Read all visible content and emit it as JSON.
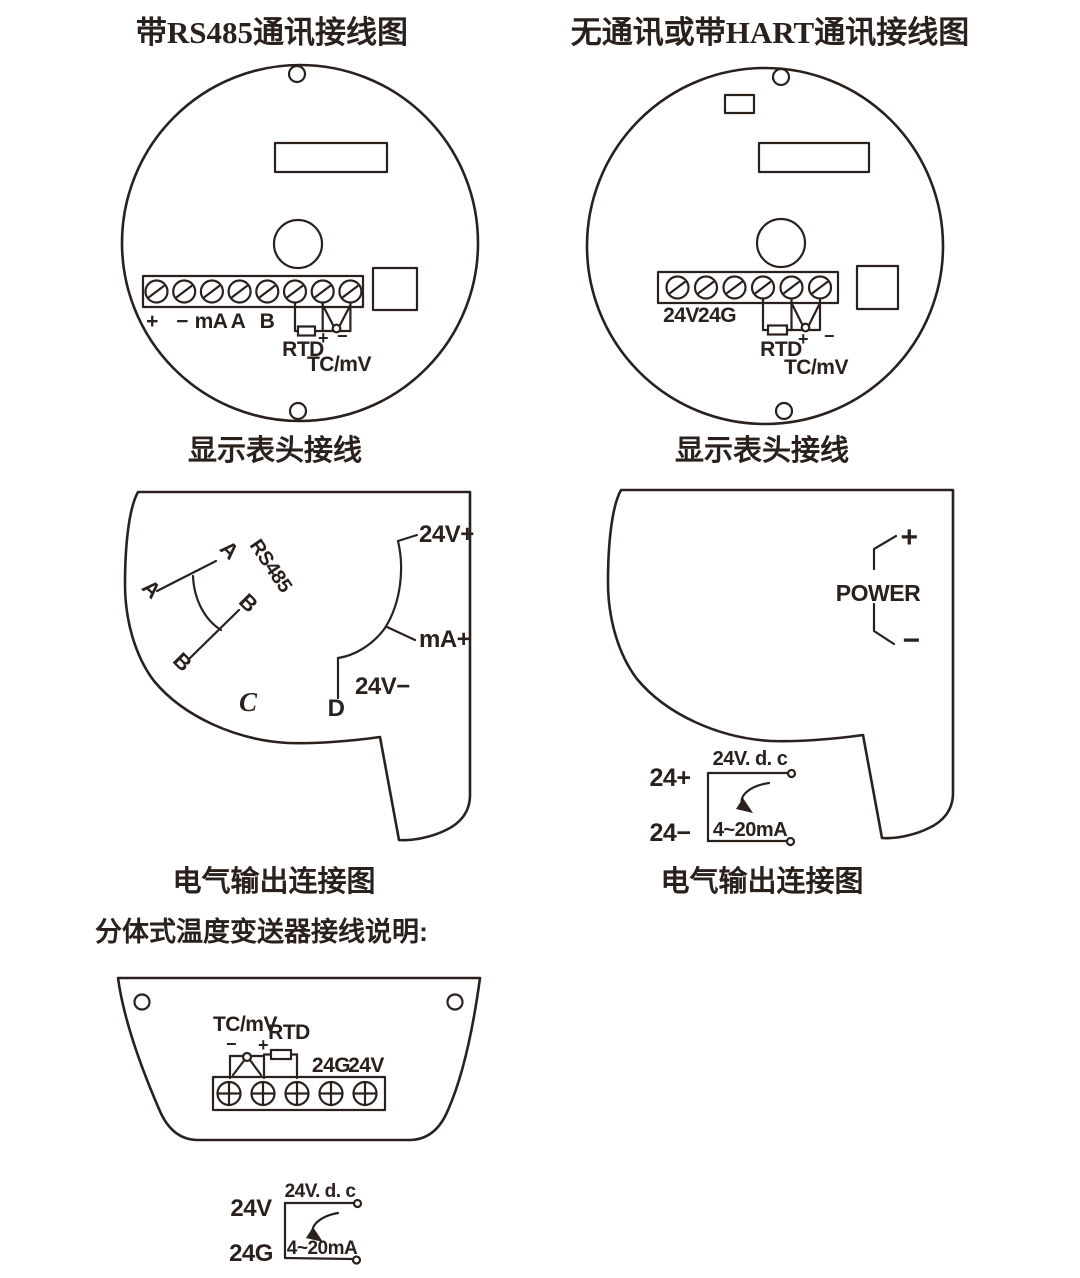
{
  "colors": {
    "line": "#2a211d",
    "background": "#ffffff"
  },
  "titles": {
    "left": "带RS485通讯接线图",
    "right": "无通讯或带HART通讯接线图"
  },
  "left_circle": {
    "terminal_labels": [
      "+",
      "−",
      "mA",
      "A",
      "B"
    ],
    "rtd": "RTD",
    "plus": "+",
    "minus": "−",
    "tc": "TC/mV",
    "caption": "显示表头接线"
  },
  "right_circle": {
    "v24": "24V",
    "g24": "24G",
    "rtd": "RTD",
    "plus": "+",
    "minus": "−",
    "tc": "TC/mV",
    "caption": "显示表头接线"
  },
  "left_output": {
    "a_lower": "A",
    "a_upper": "A",
    "rs485": "RS485",
    "b_upper": "B",
    "b_lower": "B",
    "c": "C",
    "d": "D",
    "v24_plus": "24V+",
    "ma_plus": "mA+",
    "v24_minus": "24V−",
    "caption": "电气输出连接图"
  },
  "right_output": {
    "plus": "+",
    "power": "POWER",
    "minus": "−",
    "t_plus": "24+",
    "t_minus": "24−",
    "supply": "24V. d. c",
    "current": "4~20mA",
    "caption": "电气输出连接图"
  },
  "split_section": {
    "heading": "分体式温度变送器接线说明:",
    "tc": "TC/mV",
    "rtd": "RTD",
    "minus": "−",
    "plus": "+",
    "g24": "24G",
    "v24": "24V",
    "t_v": "24V",
    "t_g": "24G",
    "supply": "24V. d. c",
    "current": "4~20mA"
  }
}
